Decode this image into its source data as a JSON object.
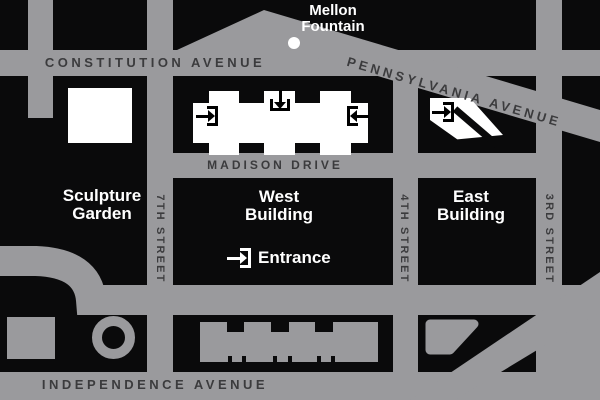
{
  "streets": {
    "constitution_avenue": "CONSTITUTION AVENUE",
    "pennsylvania_avenue": "PENNSYLVANIA AVENUE",
    "madison_drive": "MADISON DRIVE",
    "independence_avenue": "INDEPENDENCE AVENUE",
    "seventh_street": "7TH STREET",
    "fourth_street": "4TH STREET",
    "third_street": "3RD STREET"
  },
  "buildings": {
    "sculpture_garden": {
      "line1": "Sculpture",
      "line2": "Garden"
    },
    "west_building": {
      "line1": "West",
      "line2": "Building"
    },
    "east_building": {
      "line1": "East",
      "line2": "Building"
    }
  },
  "landmarks": {
    "mellon_fountain": {
      "line1": "Mellon",
      "line2": "Fountain"
    }
  },
  "entrance_label": "Entrance",
  "icons": {
    "west_left": "entrance-arrow-right-icon",
    "west_top": "entrance-arrow-down-icon",
    "west_right": "entrance-arrow-left-icon",
    "east": "entrance-arrow-right-icon",
    "main_entrance": "entrance-arrow-right-icon"
  },
  "colors": {
    "street": "#9a9a9d",
    "street_label": "#3b3b3d",
    "background": "#0a0a0b",
    "building_white": "#ffffff"
  }
}
